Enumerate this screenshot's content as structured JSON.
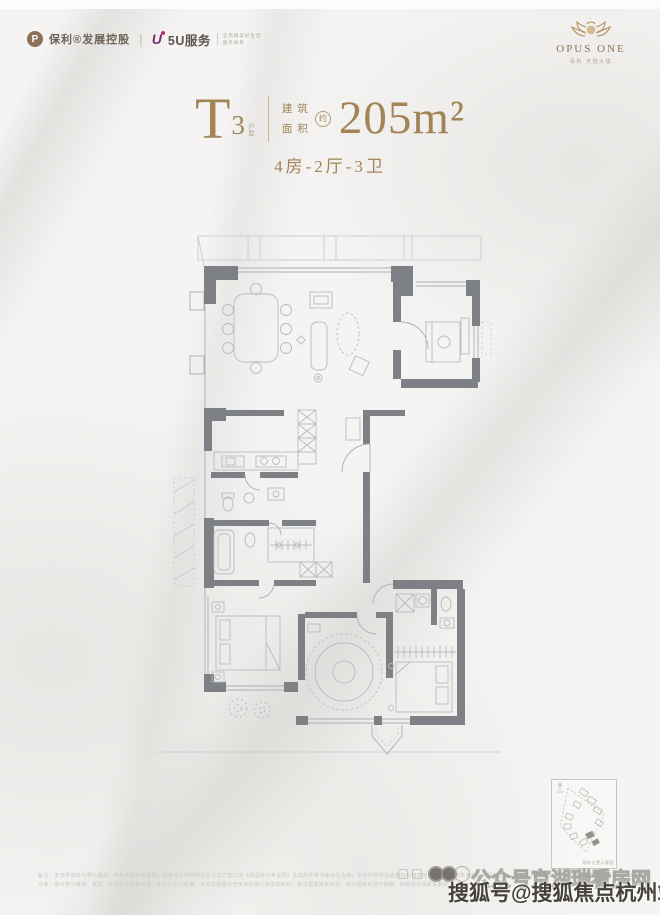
{
  "page": {
    "title": "T3户型 建筑面积约205m² 户型图"
  },
  "header": {
    "poly": {
      "label": "保利®发展控股"
    },
    "divider": "|",
    "five_u": {
      "label": "5U服务",
      "tagline_line1": "全周期美好生活",
      "tagline_line2": "服务体系"
    },
    "opus": {
      "name": "OPUS ONE",
      "subtitle": "保利·天悦大境"
    }
  },
  "title": {
    "unit_letter": "T",
    "unit_number": "3",
    "unit_tag": "户型",
    "area_label_top": "建筑",
    "area_label_bottom": "面积",
    "approx_mark": "约",
    "area_value": "205m²",
    "rooms_summary": "4房-2厅-3卫"
  },
  "floorplan": {
    "type": "apartment-floor-plan",
    "area_sqm": 205,
    "bedrooms": 4,
    "living_rooms": 2,
    "bathrooms": 3,
    "room_labels_visible": false
  },
  "keyplan": {
    "caption": "楼栋位置示意图"
  },
  "watermark": {
    "outline_text": "公众号京湖瑞看房网",
    "solid_text": "搜狐号@搜狐焦点杭州站"
  },
  "disclaimer": {
    "text": "备注：本宣传资料为要约邀请，不构成要约或承诺，买卖双方的权利义务以双方签订的《商品房买卖合同》及其附件等书面协议为准。本资料所涉及面积均为建筑面积，户型图仅供参考，房屋的结构、尺寸、布局等具体以政府部门最终审定图纸及实际交付为准。图中部分装修、家具、陈设仅为效果示意，不作为交付标准。本公司保留对宣传资料进行修改的权利，敬请留意最新资料。部分图片来源于网络，如有侵权请联系删除。"
  },
  "colors": {
    "gold": "#a18557",
    "wall_gray": "#7d8084",
    "plan_line": "#aeb3b8",
    "brand_brown": "#8a7158",
    "five_u_purple": "#7b2d6e",
    "watermark_dark": "#45413d",
    "background": "#f5f4f2"
  }
}
